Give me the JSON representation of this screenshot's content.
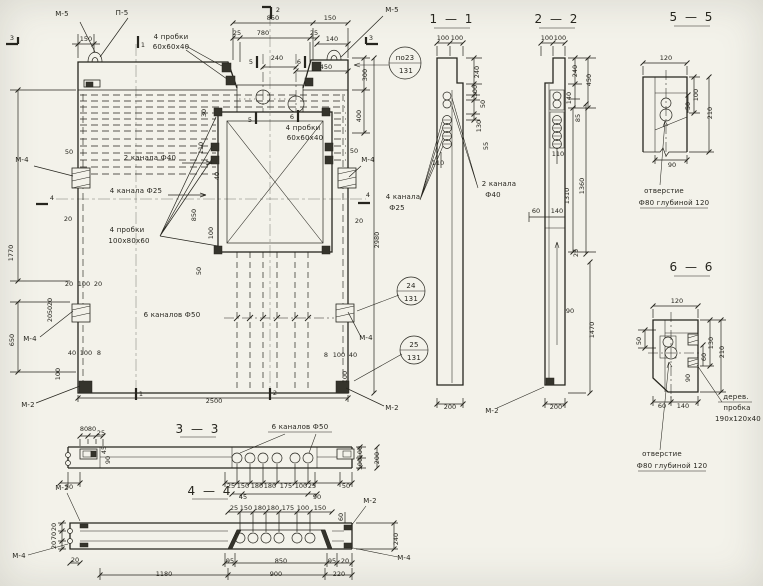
{
  "meta": {
    "drawing_type": "structural panel working drawing",
    "language": "ru",
    "paper_color": "#f3f2ea",
    "ink_color": "#26251e"
  },
  "section_titles": [
    "1 — 1",
    "2 — 2",
    "3 — 3",
    "4 — 4",
    "5 — 5",
    "6 — 6"
  ],
  "annotations": [
    {
      "t": "М-5",
      "x": 62,
      "y": 16,
      "c": "lbl",
      "n": "mark-m5-left"
    },
    {
      "t": "П-5",
      "x": 122,
      "y": 15,
      "c": "lbl",
      "n": "mark-p5"
    },
    {
      "t": "3",
      "x": 12,
      "y": 40,
      "n": "flag-3-left"
    },
    {
      "t": "1",
      "x": 143,
      "y": 47,
      "n": "flag-1-top"
    },
    {
      "t": "2",
      "x": 278,
      "y": 12,
      "n": "flag-2-top"
    },
    {
      "t": "М-5",
      "x": 392,
      "y": 12,
      "c": "lbl",
      "n": "mark-m5-right"
    },
    {
      "t": "3",
      "x": 371,
      "y": 40,
      "n": "flag-3-right"
    },
    {
      "t": "850",
      "x": 273,
      "y": 20
    },
    {
      "t": "150",
      "x": 330,
      "y": 20
    },
    {
      "t": "150",
      "x": 86,
      "y": 41
    },
    {
      "t": "25",
      "x": 237,
      "y": 35
    },
    {
      "t": "780",
      "x": 263,
      "y": 35
    },
    {
      "t": "25",
      "x": 314,
      "y": 35
    },
    {
      "t": "140",
      "x": 332,
      "y": 41
    },
    {
      "t": "4 пробки",
      "x": 171,
      "y": 39,
      "c": "lbl",
      "n": "label-4-plugs-top"
    },
    {
      "t": "60х60х40",
      "x": 171,
      "y": 49,
      "c": "lbl"
    },
    {
      "t": "5",
      "x": 251,
      "y": 64,
      "n": "flag-5-top"
    },
    {
      "t": "240",
      "x": 277,
      "y": 60
    },
    {
      "t": "6",
      "x": 299,
      "y": 64,
      "n": "flag-6-top"
    },
    {
      "t": "450",
      "x": 326,
      "y": 69
    },
    {
      "t": "300",
      "x": 367,
      "y": 75,
      "r": -90
    },
    {
      "t": "400",
      "x": 361,
      "y": 116,
      "r": -90
    },
    {
      "t": "по23",
      "x": 405,
      "y": 60,
      "c": "lbl",
      "n": "callout-po23"
    },
    {
      "t": "131",
      "x": 406,
      "y": 73,
      "c": "lbl"
    },
    {
      "t": "50",
      "x": 69,
      "y": 154
    },
    {
      "t": "М-4",
      "x": 22,
      "y": 162,
      "c": "lbl",
      "n": "mark-m4-left-top"
    },
    {
      "t": "4",
      "x": 52,
      "y": 200,
      "n": "flag-4-left"
    },
    {
      "t": "20",
      "x": 68,
      "y": 221
    },
    {
      "t": "1770",
      "x": 13,
      "y": 253,
      "r": -90
    },
    {
      "t": "2 канала Ф40",
      "x": 150,
      "y": 160,
      "c": "lbl",
      "n": "label-2-channels-f40"
    },
    {
      "t": "4 канала Ф25",
      "x": 136,
      "y": 193,
      "c": "lbl",
      "n": "label-4-channels-f25"
    },
    {
      "t": "30",
      "x": 206,
      "y": 113,
      "r": -90
    },
    {
      "t": "110",
      "x": 203,
      "y": 148,
      "r": -90
    },
    {
      "t": "40",
      "x": 219,
      "y": 176,
      "r": -90
    },
    {
      "t": "850",
      "x": 196,
      "y": 215,
      "r": -90
    },
    {
      "t": "4 пробки",
      "x": 127,
      "y": 232,
      "c": "lbl",
      "n": "label-4-plugs-opening"
    },
    {
      "t": "100х80х60",
      "x": 129,
      "y": 243,
      "c": "lbl"
    },
    {
      "t": "100",
      "x": 213,
      "y": 233,
      "r": -90
    },
    {
      "t": "50",
      "x": 201,
      "y": 271,
      "r": -90
    },
    {
      "t": "4 пробки",
      "x": 303,
      "y": 130,
      "c": "lbl",
      "n": "label-4-plugs-inner"
    },
    {
      "t": "60х60х40",
      "x": 305,
      "y": 140,
      "c": "lbl"
    },
    {
      "t": "5",
      "x": 250,
      "y": 122,
      "n": "flag-5-mid"
    },
    {
      "t": "6",
      "x": 292,
      "y": 119,
      "n": "flag-6-mid"
    },
    {
      "t": "20",
      "x": 69,
      "y": 286
    },
    {
      "t": "100",
      "x": 84,
      "y": 286
    },
    {
      "t": "20",
      "x": 98,
      "y": 286
    },
    {
      "t": "20",
      "x": 52,
      "y": 302,
      "r": -90
    },
    {
      "t": "50",
      "x": 52,
      "y": 310,
      "r": -90
    },
    {
      "t": "20",
      "x": 52,
      "y": 318,
      "r": -90
    },
    {
      "t": "М-4",
      "x": 30,
      "y": 341,
      "c": "lbl",
      "n": "mark-m4-left-bottom"
    },
    {
      "t": "650",
      "x": 14,
      "y": 340,
      "r": -90
    },
    {
      "t": "6 каналов Ф50",
      "x": 172,
      "y": 317,
      "c": "lbl",
      "n": "label-6-channels-f50"
    },
    {
      "t": "24",
      "x": 411,
      "y": 288,
      "c": "lbl",
      "n": "callout-24"
    },
    {
      "t": "131",
      "x": 411,
      "y": 301,
      "c": "lbl"
    },
    {
      "t": "25",
      "x": 414,
      "y": 347,
      "c": "lbl",
      "n": "callout-25"
    },
    {
      "t": "131",
      "x": 414,
      "y": 360,
      "c": "lbl"
    },
    {
      "t": "М-4",
      "x": 366,
      "y": 340,
      "c": "lbl",
      "n": "mark-m4-right-bottom"
    },
    {
      "t": "40",
      "x": 72,
      "y": 355
    },
    {
      "t": "100",
      "x": 86,
      "y": 355
    },
    {
      "t": "8",
      "x": 99,
      "y": 355
    },
    {
      "t": "8",
      "x": 326,
      "y": 357
    },
    {
      "t": "100",
      "x": 339,
      "y": 357
    },
    {
      "t": "40",
      "x": 353,
      "y": 357
    },
    {
      "t": "100",
      "x": 60,
      "y": 374,
      "r": -90
    },
    {
      "t": "100",
      "x": 347,
      "y": 377,
      "r": -90
    },
    {
      "t": "М-2",
      "x": 28,
      "y": 407,
      "c": "lbl",
      "n": "mark-m2-left"
    },
    {
      "t": "М-2",
      "x": 392,
      "y": 410,
      "c": "lbl",
      "n": "mark-m2-right"
    },
    {
      "t": "1",
      "x": 141,
      "y": 396,
      "n": "flag-1-bottom"
    },
    {
      "t": "2",
      "x": 275,
      "y": 395,
      "n": "flag-2-bottom"
    },
    {
      "t": "2500",
      "x": 214,
      "y": 403
    },
    {
      "t": "50",
      "x": 354,
      "y": 153
    },
    {
      "t": "20",
      "x": 359,
      "y": 223
    },
    {
      "t": "М-4",
      "x": 368,
      "y": 162,
      "c": "lbl",
      "n": "mark-m4-right-top"
    },
    {
      "t": "4",
      "x": 368,
      "y": 197,
      "n": "flag-4-right"
    },
    {
      "t": "2980",
      "x": 379,
      "y": 240,
      "r": -90
    },
    {
      "t": "1 — 1",
      "x": 452,
      "y": 23,
      "c": "ttl",
      "n": "section-title-1-1"
    },
    {
      "t": "100",
      "x": 443,
      "y": 40
    },
    {
      "t": "100",
      "x": 457,
      "y": 40
    },
    {
      "t": "240",
      "x": 479,
      "y": 72,
      "r": -90
    },
    {
      "t": "100",
      "x": 477,
      "y": 91,
      "r": -90
    },
    {
      "t": "50",
      "x": 485,
      "y": 104,
      "r": -90
    },
    {
      "t": "130",
      "x": 481,
      "y": 126,
      "r": -90
    },
    {
      "t": "55",
      "x": 488,
      "y": 146,
      "r": -90
    },
    {
      "t": "110",
      "x": 438,
      "y": 165
    },
    {
      "t": "4 канала",
      "x": 403,
      "y": 199,
      "c": "lbl",
      "n": "label-4-channels-s11"
    },
    {
      "t": "Ф25",
      "x": 397,
      "y": 210,
      "c": "lbl"
    },
    {
      "t": "2 канала",
      "x": 499,
      "y": 186,
      "c": "lbl",
      "n": "label-2-channels-s11"
    },
    {
      "t": "Ф40",
      "x": 493,
      "y": 197,
      "c": "lbl"
    },
    {
      "t": "200",
      "x": 450,
      "y": 409
    },
    {
      "t": "М-2",
      "x": 492,
      "y": 413,
      "c": "lbl",
      "n": "mark-m2-s22"
    },
    {
      "t": "2 — 2",
      "x": 557,
      "y": 23,
      "c": "ttl",
      "n": "section-title-2-2"
    },
    {
      "t": "100",
      "x": 547,
      "y": 40
    },
    {
      "t": "100",
      "x": 560,
      "y": 40
    },
    {
      "t": "240",
      "x": 577,
      "y": 71,
      "r": -90
    },
    {
      "t": "450",
      "x": 591,
      "y": 80,
      "r": -90
    },
    {
      "t": "140",
      "x": 571,
      "y": 98,
      "r": -90
    },
    {
      "t": "85",
      "x": 580,
      "y": 118,
      "r": -90
    },
    {
      "t": "110",
      "x": 558,
      "y": 156
    },
    {
      "t": "60",
      "x": 536,
      "y": 213
    },
    {
      "t": "140",
      "x": 557,
      "y": 213
    },
    {
      "t": "1310",
      "x": 569,
      "y": 196,
      "r": -90
    },
    {
      "t": "1360",
      "x": 584,
      "y": 186,
      "r": -90
    },
    {
      "t": "25",
      "x": 578,
      "y": 253,
      "r": -90
    },
    {
      "t": "90",
      "x": 570,
      "y": 313
    },
    {
      "t": "1470",
      "x": 594,
      "y": 330,
      "r": -90
    },
    {
      "t": "200",
      "x": 556,
      "y": 409
    },
    {
      "t": "5 — 5",
      "x": 692,
      "y": 21,
      "c": "ttl",
      "n": "section-title-5-5"
    },
    {
      "t": "120",
      "x": 666,
      "y": 60
    },
    {
      "t": "100",
      "x": 698,
      "y": 95,
      "r": -90
    },
    {
      "t": "50",
      "x": 690,
      "y": 106,
      "r": -90
    },
    {
      "t": "210",
      "x": 712,
      "y": 113,
      "r": -90
    },
    {
      "t": "90",
      "x": 672,
      "y": 167
    },
    {
      "t": "отверстие",
      "x": 664,
      "y": 193,
      "c": "lbl",
      "n": "label-hole-55"
    },
    {
      "t": "Ф80 глубиной 120",
      "x": 674,
      "y": 205,
      "c": "lbl"
    },
    {
      "t": "6 — 6",
      "x": 692,
      "y": 271,
      "c": "ttl",
      "n": "section-title-6-6"
    },
    {
      "t": "120",
      "x": 677,
      "y": 303
    },
    {
      "t": "50",
      "x": 641,
      "y": 341,
      "r": -90
    },
    {
      "t": "130",
      "x": 713,
      "y": 343,
      "r": -90
    },
    {
      "t": "60",
      "x": 706,
      "y": 357,
      "r": -90
    },
    {
      "t": "210",
      "x": 724,
      "y": 352,
      "r": -90
    },
    {
      "t": "90",
      "x": 690,
      "y": 378,
      "r": -90
    },
    {
      "t": "60",
      "x": 662,
      "y": 408
    },
    {
      "t": "140",
      "x": 683,
      "y": 408
    },
    {
      "t": "дерев.",
      "x": 736,
      "y": 399,
      "c": "lbl",
      "n": "label-wood-plug"
    },
    {
      "t": "пробка",
      "x": 737,
      "y": 410,
      "c": "lbl"
    },
    {
      "t": "190х120х40",
      "x": 738,
      "y": 421,
      "c": "lbl"
    },
    {
      "t": "отверстие",
      "x": 662,
      "y": 456,
      "c": "lbl",
      "n": "label-hole-66"
    },
    {
      "t": "Ф80 глубиной 120",
      "x": 672,
      "y": 468,
      "c": "lbl"
    },
    {
      "t": "3 — 3",
      "x": 198,
      "y": 433,
      "c": "ttl",
      "n": "section-title-3-3"
    },
    {
      "t": "6 каналов Ф50",
      "x": 300,
      "y": 429,
      "c": "lbl",
      "n": "label-6-channels-33"
    },
    {
      "t": "80",
      "x": 84,
      "y": 431
    },
    {
      "t": "80",
      "x": 92,
      "y": 431
    },
    {
      "t": "25",
      "x": 101,
      "y": 435
    },
    {
      "t": "45",
      "x": 106,
      "y": 450,
      "r": -90
    },
    {
      "t": "90",
      "x": 110,
      "y": 460,
      "r": -90
    },
    {
      "t": "50",
      "x": 69,
      "y": 489
    },
    {
      "t": "25",
      "x": 231,
      "y": 488
    },
    {
      "t": "150",
      "x": 243,
      "y": 488
    },
    {
      "t": "180",
      "x": 257,
      "y": 488
    },
    {
      "t": "180",
      "x": 270,
      "y": 488
    },
    {
      "t": "175",
      "x": 286,
      "y": 488
    },
    {
      "t": "100",
      "x": 301,
      "y": 488
    },
    {
      "t": "25",
      "x": 312,
      "y": 488
    },
    {
      "t": "50",
      "x": 346,
      "y": 488
    },
    {
      "t": "45",
      "x": 243,
      "y": 499
    },
    {
      "t": "90",
      "x": 317,
      "y": 499
    },
    {
      "t": "100",
      "x": 362,
      "y": 452,
      "r": -90
    },
    {
      "t": "100",
      "x": 362,
      "y": 464,
      "r": -90
    },
    {
      "t": "200",
      "x": 379,
      "y": 458,
      "r": -90
    },
    {
      "t": "4 — 4",
      "x": 210,
      "y": 495,
      "c": "ttl",
      "n": "section-title-4-4"
    },
    {
      "t": "М-2",
      "x": 62,
      "y": 490,
      "c": "lbl",
      "n": "mark-m2-44-left"
    },
    {
      "t": "20",
      "x": 56,
      "y": 527,
      "r": -90
    },
    {
      "t": "70",
      "x": 56,
      "y": 536,
      "r": -90
    },
    {
      "t": "20",
      "x": 56,
      "y": 545,
      "r": -90
    },
    {
      "t": "М-4",
      "x": 19,
      "y": 558,
      "c": "lbl",
      "n": "mark-m4-44-left"
    },
    {
      "t": "20",
      "x": 75,
      "y": 562
    },
    {
      "t": "25",
      "x": 234,
      "y": 510
    },
    {
      "t": "150",
      "x": 246,
      "y": 510
    },
    {
      "t": "180",
      "x": 260,
      "y": 510
    },
    {
      "t": "180",
      "x": 273,
      "y": 510
    },
    {
      "t": "175",
      "x": 288,
      "y": 510
    },
    {
      "t": "100",
      "x": 303,
      "y": 510
    },
    {
      "t": "150",
      "x": 320,
      "y": 510
    },
    {
      "t": "60",
      "x": 343,
      "y": 517,
      "r": -90
    },
    {
      "t": "М-2",
      "x": 370,
      "y": 503,
      "c": "lbl",
      "n": "mark-m2-44-right"
    },
    {
      "t": "240",
      "x": 398,
      "y": 539,
      "r": -90
    },
    {
      "t": "М-4",
      "x": 404,
      "y": 560,
      "c": "lbl",
      "n": "mark-m4-44-right"
    },
    {
      "t": "95",
      "x": 230,
      "y": 563
    },
    {
      "t": "850",
      "x": 281,
      "y": 563
    },
    {
      "t": "95",
      "x": 332,
      "y": 563
    },
    {
      "t": "20",
      "x": 345,
      "y": 563
    },
    {
      "t": "1180",
      "x": 164,
      "y": 576
    },
    {
      "t": "900",
      "x": 276,
      "y": 576
    },
    {
      "t": "220",
      "x": 339,
      "y": 576
    }
  ]
}
